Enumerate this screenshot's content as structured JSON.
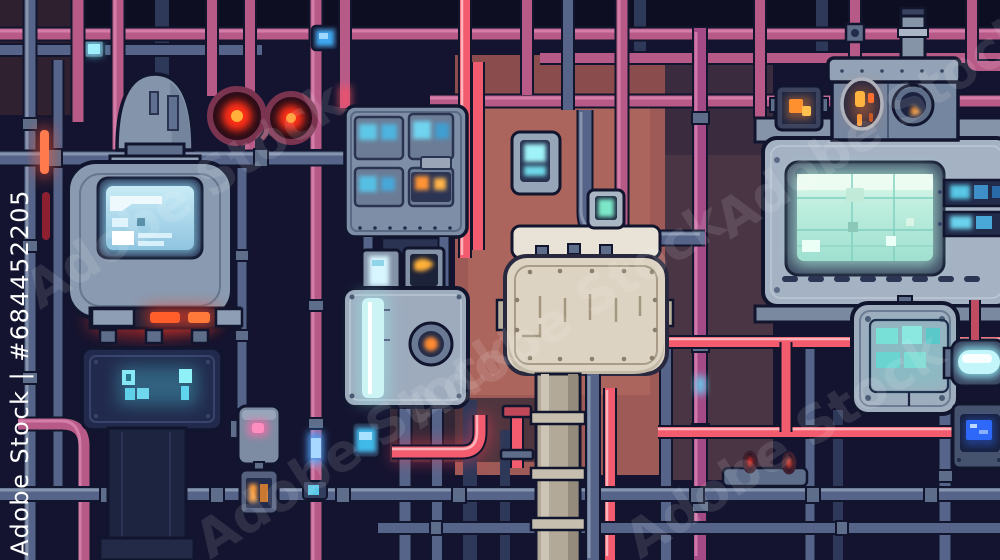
{
  "watermark": {
    "vertical_label": "Adobe Stock | #684452205",
    "tile_label": "Adobe Stock",
    "stock_id": "#684452205"
  },
  "palette": {
    "bg": "#141430",
    "navyPanel": "#222a4a",
    "outline": "#11152d",
    "salmon": "#9d5a56",
    "salmonLight": "#b06a60",
    "maroon": "#4a3545",
    "pipePink": "#b85a88",
    "pipePinkLight": "#e08cb8",
    "pipeMagenta": "#a44a86",
    "pipeGrey": "#56648a",
    "pipeRedGlow": "#f25c6e",
    "metal": "#8e9eb4",
    "metalLight": "#b7c3d2",
    "metalDark": "#5d6d8a",
    "beige": "#ddd3c2",
    "beigeDark": "#b3a998",
    "screenCyan": "#7fe3f2",
    "screenMint": "#bfeede",
    "screenBlue": "#2e68f8",
    "glowOrange": "#ffa03c",
    "lampRed": "#ff3722",
    "lampPink": "#ff6aa8"
  }
}
